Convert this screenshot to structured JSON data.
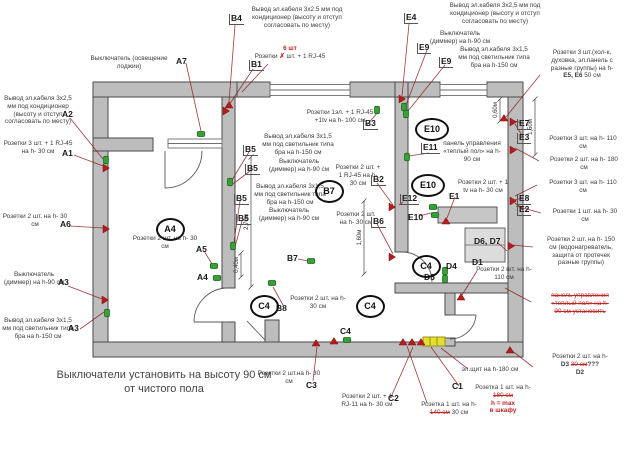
{
  "footer": {
    "line1": "Выключатели установить на высоту 90 см",
    "line2": "от чистого пола"
  },
  "colors": {
    "wall_fill": "#bdbdbd",
    "wall_stroke": "#4a4a4a",
    "leader_red": "#8c1a1a",
    "marker_green": "#36a136",
    "marker_red": "#b41d1d",
    "panel_yellow": "#e4de32",
    "note_red": "#c22525"
  },
  "annotations": [
    {
      "name": "a7-switch-note",
      "x": 78,
      "y": 55,
      "w": 102,
      "lines": [
        "Выключатель (освещение лоджии)"
      ]
    },
    {
      "name": "a2-cable-note",
      "x": 2,
      "y": 95,
      "w": 72,
      "lines": [
        "Вывод эл.кабеля 3х2,5",
        "мм под кондиционер",
        "(высоту и отступ",
        "согласовать по месту)"
      ]
    },
    {
      "name": "a1-sockets-note",
      "x": 2,
      "y": 140,
      "w": 72,
      "lines": [
        "Розетки 3 шт. + 1 RJ-45",
        "на h- 30 см"
      ]
    },
    {
      "name": "a6-sockets-note",
      "x": 2,
      "y": 213,
      "w": 66,
      "lines": [
        "Розетки 2 шт. на h- 30",
        "см"
      ]
    },
    {
      "name": "a3-switch-note",
      "x": 2,
      "y": 271,
      "w": 64,
      "lines": [
        "Выключатель",
        "(диммер) на h-90 см"
      ]
    },
    {
      "name": "a3-cable-note",
      "x": 2,
      "y": 317,
      "w": 72,
      "lines": [
        "Вывод эл.кабеля 3х1,5",
        "мм под светильник типа",
        "бра на h-150 см"
      ]
    },
    {
      "name": "b4-cable-note",
      "x": 242,
      "y": 6,
      "w": 110,
      "lines": [
        "Вывод эл.кабеля 3х2.5 мм под",
        "кондиционер (высоту и отступ",
        "согласовать по месту)"
      ]
    },
    {
      "name": "b1-qty-note",
      "x": 250,
      "y": 45,
      "w": 80,
      "lines": [
        [
          {
            "t": "6 шт",
            "b": 1,
            "r": 1
          }
        ],
        [
          {
            "t": "Розетки "
          },
          {
            "t": "✗",
            "b": 1,
            "r": 1
          },
          {
            "t": " шт. + 1 RJ-45"
          }
        ],
        [
          "на h- 30 см"
        ]
      ]
    },
    {
      "name": "e4-cable-note",
      "x": 420,
      "y": 2,
      "w": 150,
      "lines": [
        "Вывод эл.кабеля 3х2,5 мм под",
        "кондиционер (высоту и отступ",
        "согласовать по месту)"
      ]
    },
    {
      "name": "e9-switch-note",
      "x": 420,
      "y": 30,
      "w": 80,
      "lines": [
        "Выключатель",
        "(диммер) на h-90 см"
      ]
    },
    {
      "name": "e9-cable-note",
      "x": 450,
      "y": 46,
      "w": 88,
      "lines": [
        "Вывод эл.кабеля 3х1,5",
        "мм под светильник типа",
        "бра на h-150 см"
      ]
    },
    {
      "name": "e5e6-sockets-note",
      "x": 536,
      "y": 49,
      "w": 92,
      "lines": [
        "Розетки 3 шт.(хол-к,",
        "духовка, эл.панель с",
        "разные группы) на h-",
        [
          {
            "t": "E5, E6",
            "b": 1
          },
          {
            "t": "  50 см"
          }
        ]
      ]
    },
    {
      "name": "e7e3-sockets-note",
      "x": 538,
      "y": 135,
      "w": 90,
      "lines": [
        "Розетки 3 шт. на h- 110",
        "см"
      ]
    },
    {
      "name": "sockets-180-note",
      "x": 540,
      "y": 156,
      "w": 88,
      "lines": [
        "Розетки 2 шт. на h- 180",
        "см"
      ]
    },
    {
      "name": "sockets-110b-note",
      "x": 538,
      "y": 179,
      "w": 90,
      "lines": [
        "Розетки 3 шт. на h- 110",
        "см"
      ]
    },
    {
      "name": "sockets-30-note",
      "x": 542,
      "y": 208,
      "w": 86,
      "lines": [
        "Розетки 1 шт. на h- 30",
        "см"
      ]
    },
    {
      "name": "d6d7-sockets-note",
      "x": 534,
      "y": 236,
      "w": 94,
      "lines": [
        "Розетки 2 шт. на h- 150",
        "см (водонагреватель,",
        "защита от протечек",
        "разные группы)"
      ]
    },
    {
      "name": "heated-floor-cancelled-note",
      "x": 532,
      "y": 292,
      "w": 96,
      "lines": [
        [
          {
            "t": "панель управления",
            "r": 1,
            "s": 1
          }
        ],
        [
          {
            "t": "«теплый пол» на h-",
            "r": 1,
            "s": 1
          }
        ],
        [
          {
            "t": "90 см установить",
            "r": 1,
            "s": 1
          }
        ]
      ]
    },
    {
      "name": "d3d2-sockets-note",
      "x": 534,
      "y": 353,
      "w": 92,
      "lines": [
        "Розетки 2 шт. на h-",
        [
          {
            "t": "D3 ",
            "b": 1
          },
          {
            "t": "30 см",
            "r": 1,
            "s": 1
          },
          {
            "t": "???",
            "b": 1
          }
        ],
        [
          {
            "t": "D2",
            "b": 1
          }
        ]
      ]
    },
    {
      "name": "panel-board-note",
      "x": 446,
      "y": 366,
      "w": 88,
      "lines": [
        "эл.щит на h-180 см"
      ]
    },
    {
      "name": "c1-socket-note",
      "x": 468,
      "y": 384,
      "w": 70,
      "lines": [
        "Розетка 1 шт. на h-",
        [
          {
            "t": "180 см",
            "r": 1,
            "s": 1
          }
        ],
        [
          {
            "t": "h = max",
            "r": 1,
            "b": 1
          }
        ],
        [
          {
            "t": "в шкафу",
            "r": 1,
            "b": 1
          }
        ]
      ]
    },
    {
      "name": "domofon-socket-note",
      "x": 404,
      "y": 401,
      "w": 90,
      "lines": [
        "Розетка 1 шт. на h-",
        [
          {
            "t": "140 см",
            "r": 1,
            "s": 1
          },
          {
            "t": " 30 см"
          }
        ],
        [
          "(видеодомофон)"
        ]
      ]
    },
    {
      "name": "c3-sockets-note",
      "x": 250,
      "y": 370,
      "w": 78,
      "lines": [
        "Розетки 2 шт.на h- 30",
        "см"
      ]
    },
    {
      "name": "c2-sockets-note",
      "x": 334,
      "y": 393,
      "w": 66,
      "lines": [
        "Розетки 2 шт. + 1",
        "RJ-11 на h- 30 см"
      ]
    },
    {
      "name": "b3-sockets-note",
      "x": 300,
      "y": 109,
      "w": 80,
      "lines": [
        "Розетки 1эл. + 1 RJ-45",
        "+1tv на h- 100 см"
      ]
    },
    {
      "name": "b5-cable-note-1",
      "x": 258,
      "y": 133,
      "w": 80,
      "lines": [
        "Вывод эл.кабеля 3х1,5",
        "мм под светильник типа",
        "бра на h-150 см"
      ]
    },
    {
      "name": "b5-switch-note-1",
      "x": 262,
      "y": 158,
      "w": 74,
      "lines": [
        "Выключатель",
        "(диммер) на h-90 см"
      ]
    },
    {
      "name": "b5-cable-note-2",
      "x": 250,
      "y": 183,
      "w": 80,
      "lines": [
        "Вывод эл.кабеля 3х1,5",
        "мм под светильник типа",
        "бра на h-150 см"
      ]
    },
    {
      "name": "b5-switch-note-2",
      "x": 252,
      "y": 207,
      "w": 74,
      "lines": [
        "Выключатель",
        "(диммер) на h-90 см"
      ]
    },
    {
      "name": "b2-sockets-note",
      "x": 334,
      "y": 164,
      "w": 48,
      "lines": [
        "Розетки 2 шт. +",
        "1 RJ-45 на h-",
        "30 см"
      ]
    },
    {
      "name": "b6-sockets-note",
      "x": 332,
      "y": 211,
      "w": 48,
      "lines": [
        "Розетки 2 шт.",
        "на h- 30 см"
      ]
    },
    {
      "name": "a5-sockets-note",
      "x": 126,
      "y": 235,
      "w": 78,
      "lines": [
        "Розетки 2 шт. на h- 30",
        "см"
      ]
    },
    {
      "name": "b8-sockets-note",
      "x": 286,
      "y": 295,
      "w": 64,
      "lines": [
        "Розетки 2 шт. на h-",
        "30 см"
      ]
    },
    {
      "name": "e11-panel-note",
      "x": 440,
      "y": 140,
      "w": 64,
      "lines": [
        "панель управления",
        "«теплый пол» на h-",
        "90 см"
      ]
    },
    {
      "name": "e1-sockets-note",
      "x": 452,
      "y": 179,
      "w": 62,
      "lines": [
        "Розетки 2 шт. + 1",
        "tv на h- 30 см"
      ]
    },
    {
      "name": "d1-sockets-note",
      "x": 476,
      "y": 266,
      "w": 56,
      "lines": [
        "Розетки 2 шт. на h-",
        "110 см"
      ]
    }
  ],
  "code_labels": [
    {
      "t": "A7",
      "x": 176,
      "y": 57
    },
    {
      "t": "A2",
      "x": 62,
      "y": 110
    },
    {
      "t": "A1",
      "x": 62,
      "y": 149
    },
    {
      "t": "A6",
      "x": 60,
      "y": 220
    },
    {
      "t": "A3",
      "x": 58,
      "y": 278
    },
    {
      "t": "A3",
      "x": 68,
      "y": 324
    },
    {
      "t": "A5",
      "x": 196,
      "y": 245
    },
    {
      "t": "A4",
      "x": 197,
      "y": 273
    },
    {
      "t": "B4",
      "x": 229,
      "y": 14,
      "tick": 1
    },
    {
      "t": "B1",
      "x": 249,
      "y": 60,
      "tick": 1
    },
    {
      "t": "E4",
      "x": 404,
      "y": 13,
      "tick": 1
    },
    {
      "t": "E9",
      "x": 417,
      "y": 43,
      "tick": 1
    },
    {
      "t": "E9",
      "x": 439,
      "y": 57,
      "tick": 1
    },
    {
      "t": "B5",
      "x": 243,
      "y": 145,
      "tick": 1
    },
    {
      "t": "B5",
      "x": 245,
      "y": 164,
      "tick": 1
    },
    {
      "t": "B5",
      "x": 234,
      "y": 194,
      "tick": 1
    },
    {
      "t": "B5",
      "x": 236,
      "y": 214,
      "tick": 1
    },
    {
      "t": "B3",
      "x": 363,
      "y": 119,
      "tick": 1
    },
    {
      "t": "B2",
      "x": 371,
      "y": 175,
      "tick": 1
    },
    {
      "t": "B6",
      "x": 371,
      "y": 217,
      "tick": 1
    },
    {
      "t": "B7",
      "x": 287,
      "y": 254
    },
    {
      "t": "B8",
      "x": 276,
      "y": 304
    },
    {
      "t": "C1",
      "x": 452,
      "y": 382
    },
    {
      "t": "C2",
      "x": 388,
      "y": 394
    },
    {
      "t": "C3",
      "x": 306,
      "y": 381
    },
    {
      "t": "E7",
      "x": 517,
      "y": 119,
      "tick": 1
    },
    {
      "t": "E3",
      "x": 517,
      "y": 133,
      "tick": 1
    },
    {
      "t": "E8",
      "x": 517,
      "y": 194,
      "tick": 1
    },
    {
      "t": "E2",
      "x": 517,
      "y": 205,
      "tick": 1
    },
    {
      "t": "E1",
      "x": 449,
      "y": 192
    },
    {
      "t": "E10",
      "x": 408,
      "y": 213
    },
    {
      "t": "E11",
      "x": 421,
      "y": 143,
      "tick": 1
    },
    {
      "t": "E12",
      "x": 400,
      "y": 194,
      "tick": 1
    },
    {
      "t": "D1",
      "x": 472,
      "y": 258
    },
    {
      "t": "D4",
      "x": 446,
      "y": 262
    },
    {
      "t": "D5",
      "x": 424,
      "y": 273
    },
    {
      "t": "D6, D7",
      "x": 474,
      "y": 237
    },
    {
      "t": "C4",
      "x": 340,
      "y": 327
    }
  ],
  "circle_labels": [
    {
      "t": "A4",
      "x": 168,
      "y": 227
    },
    {
      "t": "B7",
      "x": 327,
      "y": 189
    },
    {
      "t": "C4",
      "x": 262,
      "y": 304
    },
    {
      "t": "C4",
      "x": 368,
      "y": 304
    },
    {
      "t": "C4",
      "x": 424,
      "y": 264
    },
    {
      "t": "E10",
      "x": 430,
      "y": 127
    },
    {
      "t": "E10",
      "x": 426,
      "y": 183
    }
  ],
  "plan": {
    "dims": [
      {
        "t": "0,60м",
        "x": 500,
        "y1": 99,
        "y2": 121
      },
      {
        "t": "1,50м",
        "x": 535,
        "y1": 99,
        "y2": 155
      },
      {
        "t": "1,60м",
        "x": 364,
        "y1": 201,
        "y2": 274
      },
      {
        "t": "2,70м",
        "x": 251,
        "y1": 157,
        "y2": 287
      },
      {
        "t": "0,40м",
        "x": 241,
        "y1": 253,
        "y2": 277
      }
    ],
    "markers": [
      {
        "n": "switch-loggia-a7",
        "t": "g",
        "x": 201,
        "y": 134
      },
      {
        "n": "outlet-a2",
        "t": "g",
        "x": 106,
        "y": 160,
        "v": 1
      },
      {
        "n": "socket-a1",
        "t": "r",
        "x": 106,
        "y": 168,
        "v": 1
      },
      {
        "n": "socket-a6",
        "t": "r",
        "x": 106,
        "y": 229,
        "v": 1
      },
      {
        "n": "socket-a3",
        "t": "r",
        "x": 105,
        "y": 300,
        "v": 1
      },
      {
        "n": "outlet-a3-bra",
        "t": "g",
        "x": 107,
        "y": 313,
        "v": 1
      },
      {
        "n": "cable-b4",
        "t": "r",
        "x": 229,
        "y": 105
      },
      {
        "n": "socket-b1",
        "t": "r",
        "x": 226,
        "y": 111,
        "v": 1
      },
      {
        "n": "outlet-b5-1",
        "t": "g",
        "x": 230,
        "y": 182,
        "v": 1
      },
      {
        "n": "outlet-b5-2",
        "t": "g",
        "x": 233,
        "y": 246,
        "v": 1
      },
      {
        "n": "outlet-a5",
        "t": "g",
        "x": 214,
        "y": 266
      },
      {
        "n": "outlet-a4",
        "t": "g",
        "x": 217,
        "y": 278
      },
      {
        "n": "outlet-b7",
        "t": "g",
        "x": 311,
        "y": 261
      },
      {
        "n": "outlet-b8",
        "t": "g",
        "x": 272,
        "y": 283
      },
      {
        "n": "outlet-b3",
        "t": "g",
        "x": 377,
        "y": 110,
        "v": 1
      },
      {
        "n": "cable-e4",
        "t": "r",
        "x": 402,
        "y": 99,
        "v": 1
      },
      {
        "n": "outlet-e9-1",
        "t": "g",
        "x": 404,
        "y": 107,
        "v": 1
      },
      {
        "n": "outlet-e9-2",
        "t": "g",
        "x": 406,
        "y": 114,
        "v": 1
      },
      {
        "n": "outlet-e11",
        "t": "g",
        "x": 407,
        "y": 157,
        "v": 1
      },
      {
        "n": "socket-b2",
        "t": "r",
        "x": 392,
        "y": 207,
        "v": 1
      },
      {
        "n": "socket-b6",
        "t": "r",
        "x": 392,
        "y": 257,
        "v": 1
      },
      {
        "n": "outlet-e10-1",
        "t": "g",
        "x": 433,
        "y": 207
      },
      {
        "n": "outlet-e10-2",
        "t": "g",
        "x": 435,
        "y": 215
      },
      {
        "n": "socket-e1",
        "t": "r",
        "x": 446,
        "y": 221
      },
      {
        "n": "outlet-d4",
        "t": "g",
        "x": 445,
        "y": 271,
        "v": 1
      },
      {
        "n": "outlet-d5",
        "t": "g",
        "x": 445,
        "y": 279,
        "v": 1
      },
      {
        "n": "socket-d1",
        "t": "r",
        "x": 461,
        "y": 297
      },
      {
        "n": "socket-corner",
        "t": "r",
        "x": 504,
        "y": 118
      },
      {
        "n": "socket-e7e3",
        "t": "r",
        "x": 513,
        "y": 122,
        "v": 1
      },
      {
        "n": "socket-180",
        "t": "r",
        "x": 513,
        "y": 150,
        "v": 1
      },
      {
        "n": "socket-e8e2",
        "t": "r",
        "x": 513,
        "y": 201,
        "v": 1
      },
      {
        "n": "socket-d6d7",
        "t": "r",
        "x": 511,
        "y": 246,
        "v": 1
      },
      {
        "n": "socket-d3",
        "t": "r",
        "x": 510,
        "y": 350
      },
      {
        "n": "socket-c4",
        "t": "r",
        "x": 334,
        "y": 341
      },
      {
        "n": "outlet-c4",
        "t": "g",
        "x": 347,
        "y": 340
      },
      {
        "n": "socket-c3",
        "t": "r",
        "x": 316,
        "y": 343
      },
      {
        "n": "socket-hall-1",
        "t": "r",
        "x": 403,
        "y": 342
      },
      {
        "n": "socket-hall-2",
        "t": "r",
        "x": 412,
        "y": 342
      },
      {
        "n": "socket-hall-3",
        "t": "r",
        "x": 421,
        "y": 342
      }
    ],
    "leaders": [
      [
        186,
        63,
        201,
        131
      ],
      [
        70,
        118,
        103,
        159
      ],
      [
        74,
        155,
        103,
        166
      ],
      [
        70,
        226,
        103,
        228
      ],
      [
        68,
        286,
        102,
        299
      ],
      [
        80,
        329,
        104,
        312
      ],
      [
        204,
        251,
        212,
        264
      ],
      [
        235,
        25,
        229,
        102
      ],
      [
        253,
        69,
        227,
        108
      ],
      [
        268,
        64,
        242,
        92
      ],
      [
        409,
        24,
        402,
        96
      ],
      [
        427,
        50,
        406,
        105
      ],
      [
        445,
        65,
        408,
        111
      ],
      [
        249,
        152,
        232,
        180
      ],
      [
        250,
        171,
        233,
        184
      ],
      [
        240,
        201,
        234,
        242
      ],
      [
        242,
        221,
        235,
        247
      ],
      [
        367,
        125,
        378,
        112
      ],
      [
        377,
        183,
        393,
        205
      ],
      [
        377,
        224,
        393,
        254
      ],
      [
        298,
        259,
        308,
        261
      ],
      [
        283,
        305,
        273,
        287
      ],
      [
        313,
        381,
        317,
        347
      ],
      [
        391,
        397,
        413,
        347
      ],
      [
        459,
        386,
        431,
        347
      ],
      [
        427,
        403,
        407,
        346
      ],
      [
        468,
        369,
        441,
        348
      ],
      [
        540,
        75,
        506,
        117
      ],
      [
        523,
        123,
        514,
        121
      ],
      [
        523,
        137,
        515,
        124
      ],
      [
        539,
        161,
        515,
        148
      ],
      [
        537,
        185,
        515,
        196
      ],
      [
        523,
        198,
        514,
        200
      ],
      [
        523,
        209,
        515,
        203
      ],
      [
        541,
        213,
        516,
        206
      ],
      [
        533,
        247,
        513,
        245
      ],
      [
        531,
        302,
        505,
        288
      ],
      [
        533,
        367,
        511,
        350
      ],
      [
        498,
        243,
        507,
        251
      ],
      [
        477,
        271,
        462,
        295
      ],
      [
        455,
        197,
        447,
        218
      ],
      [
        429,
        153,
        409,
        156
      ],
      [
        403,
        202,
        399,
        205
      ],
      [
        419,
        216,
        431,
        213
      ]
    ]
  }
}
